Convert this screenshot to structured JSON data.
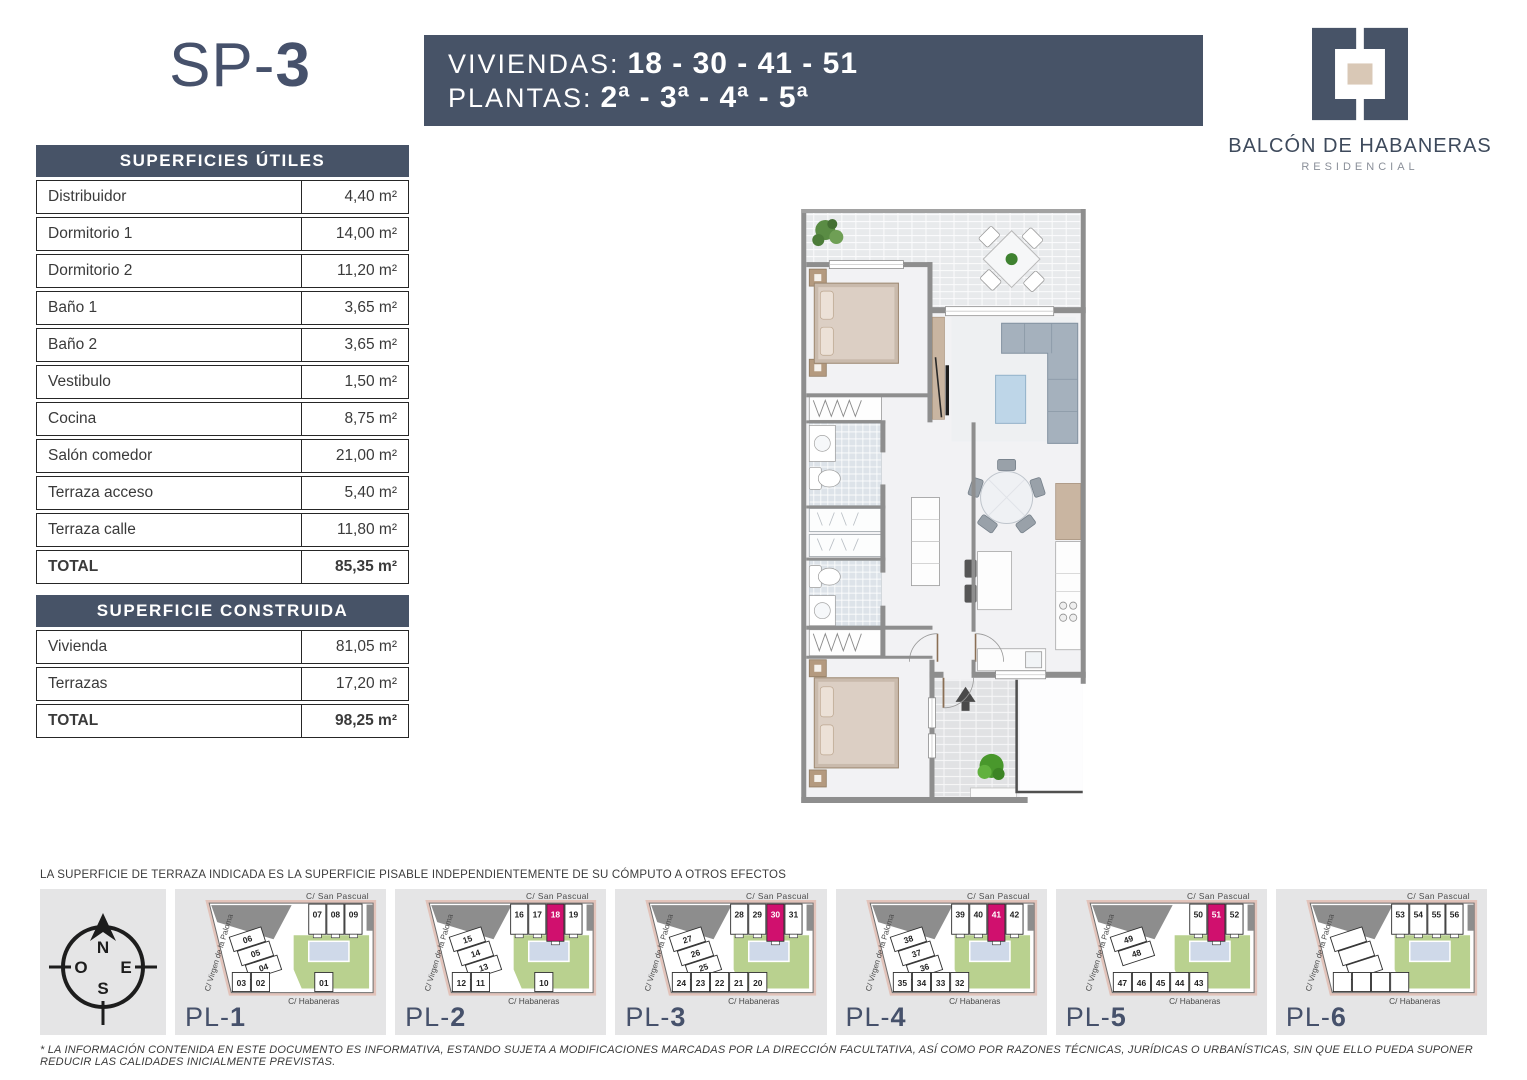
{
  "header": {
    "title_prefix": "SP-",
    "title_number": "3",
    "banner": {
      "line1_label": "VIVIENDAS:",
      "line1_value": "18 - 30 - 41 - 51",
      "line2_label": "PLANTAS:",
      "line2_value": "2ª - 3ª - 4ª - 5ª"
    },
    "logo": {
      "name": "BALCÓN DE HABANERAS",
      "subtitle": "RESIDENCIAL"
    }
  },
  "tables": {
    "superficies_utiles": {
      "title": "SUPERFICIES ÚTILES",
      "unit": "m²",
      "rows": [
        {
          "label": "Distribuidor",
          "value": "4,40"
        },
        {
          "label": "Dormitorio 1",
          "value": "14,00"
        },
        {
          "label": "Dormitorio 2",
          "value": "11,20"
        },
        {
          "label": "Baño 1",
          "value": "3,65"
        },
        {
          "label": "Baño 2",
          "value": "3,65"
        },
        {
          "label": "Vestibulo",
          "value": "1,50"
        },
        {
          "label": "Cocina",
          "value": "8,75"
        },
        {
          "label": "Salón comedor",
          "value": "21,00"
        },
        {
          "label": "Terraza acceso",
          "value": "5,40"
        },
        {
          "label": "Terraza calle",
          "value": "11,80"
        }
      ],
      "total": {
        "label": "TOTAL",
        "value": "85,35"
      }
    },
    "superficie_construida": {
      "title": "SUPERFICIE CONSTRUIDA",
      "unit": "m²",
      "rows": [
        {
          "label": "Vivienda",
          "value": "81,05"
        },
        {
          "label": "Terrazas",
          "value": "17,20"
        }
      ],
      "total": {
        "label": "TOTAL",
        "value": "98,25"
      }
    }
  },
  "disclaimer": "LA SUPERFICIE DE TERRAZA INDICADA ES LA SUPERFICIE PISABLE INDEPENDIENTEMENTE DE SU CÓMPUTO A OTROS EFECTOS",
  "footnote": "* LA INFORMACIÓN CONTENIDA EN ESTE DOCUMENTO ES INFORMATIVA, ESTANDO SUJETA A MODIFICACIONES MARCADAS POR LA DIRECCIÓN FACULTATIVA, ASÍ COMO POR RAZONES TÉCNICAS, JURÍDICAS O URBANÍSTICAS, SIN QUE ELLO PUEDA SUPONER REDUCIR LAS CALIDADES INICIALMENTE PREVISTAS.",
  "compass": {
    "n": "N",
    "e": "E",
    "s": "S",
    "o": "O"
  },
  "mini_plans": {
    "streets": {
      "top": "C/ San  Pascual",
      "left": "C/ Virgen de la Paloma",
      "bottom": "C/ Habaneras"
    },
    "items": [
      {
        "label_prefix": "PL-",
        "label_number": "1",
        "top_units": [
          "07",
          "08",
          "09"
        ],
        "mid_units": [
          "06",
          "05",
          "04"
        ],
        "bottom_units": [
          "03",
          "02"
        ],
        "bottom_right_units": [
          "01"
        ],
        "highlight": null
      },
      {
        "label_prefix": "PL-",
        "label_number": "2",
        "top_units": [
          "16",
          "17",
          "18",
          "19"
        ],
        "mid_units": [
          "15",
          "14",
          "13"
        ],
        "bottom_units": [
          "12",
          "11"
        ],
        "bottom_right_units": [
          "10"
        ],
        "highlight": "18"
      },
      {
        "label_prefix": "PL-",
        "label_number": "3",
        "top_units": [
          "28",
          "29",
          "30",
          "31"
        ],
        "mid_units": [
          "27",
          "26",
          "25"
        ],
        "bottom_units": [
          "24",
          "23",
          "22",
          "21",
          "20"
        ],
        "bottom_right_units": [],
        "highlight": "30"
      },
      {
        "label_prefix": "PL-",
        "label_number": "4",
        "top_units": [
          "39",
          "40",
          "41",
          "42"
        ],
        "mid_units": [
          "38",
          "37",
          "36"
        ],
        "bottom_units": [
          "35",
          "34",
          "33",
          "32"
        ],
        "bottom_right_units": [],
        "highlight": "41"
      },
      {
        "label_prefix": "PL-",
        "label_number": "5",
        "top_units": [
          "50",
          "51",
          "52"
        ],
        "mid_units": [
          "49",
          "48"
        ],
        "bottom_units": [
          "47",
          "46",
          "45",
          "44",
          "43"
        ],
        "bottom_right_units": [],
        "highlight": "51"
      },
      {
        "label_prefix": "PL-",
        "label_number": "6",
        "top_units": [
          "53",
          "54",
          "55",
          "56"
        ],
        "mid_units": [
          "",
          "",
          ""
        ],
        "bottom_units": [
          "",
          "",
          "",
          ""
        ],
        "bottom_right_units": [],
        "highlight": null
      }
    ]
  },
  "colors": {
    "navy": "#475367",
    "highlight": "#D0106E",
    "courtyard_green": "#B9D18F",
    "pool": "#CFD9E9",
    "dark_block": "#8D8D8D",
    "street_band": "#E2C3BA",
    "panel_bg": "#E5E5E6"
  }
}
